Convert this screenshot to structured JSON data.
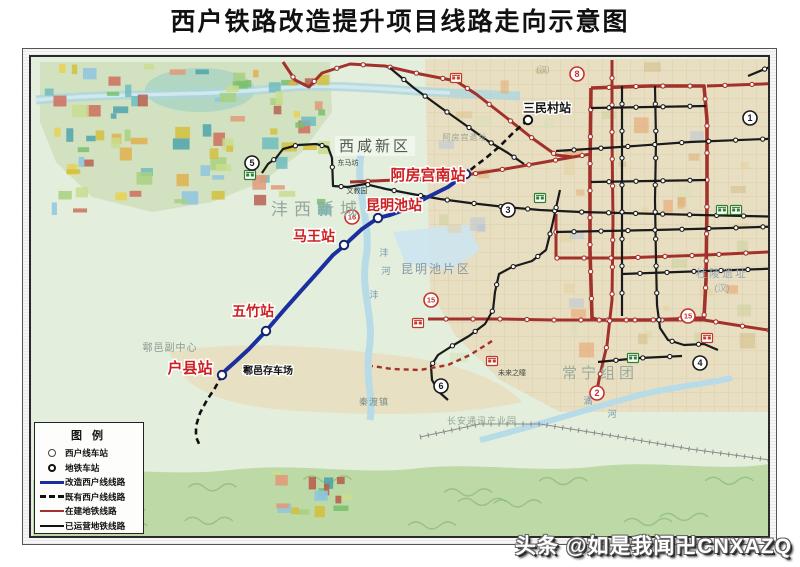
{
  "title": "西户铁路改造提升项目线路走向示意图",
  "watermark": "头条 @如是我闻卍CNXAZQ",
  "legend": {
    "title": "图例",
    "items": [
      {
        "symbol": "circle-thin",
        "label": "西户线车站"
      },
      {
        "symbol": "circle-bold",
        "label": "地铁车站"
      },
      {
        "symbol": "line-blue",
        "label": "改造西户线线路"
      },
      {
        "symbol": "line-dash",
        "label": "既有西户线线路"
      },
      {
        "symbol": "line-red",
        "label": "在建地铁线路"
      },
      {
        "symbol": "line-black",
        "label": "已运营地铁线路"
      }
    ]
  },
  "colors": {
    "renovated_line": "#1b2f9e",
    "metro_under_construction": "#a3312b",
    "metro_operating": "#1a1a1a",
    "station_label_red": "#cc1f1f",
    "badge_red": "#c2342c",
    "badge_black": "#1a1a1a"
  },
  "map": {
    "blue_line": {
      "points": [
        [
          466,
          174
        ],
        [
          448,
          187
        ],
        [
          426,
          198
        ],
        [
          404,
          210
        ],
        [
          390,
          215
        ],
        [
          378,
          218
        ],
        [
          362,
          229
        ],
        [
          350,
          240
        ],
        [
          344,
          246
        ],
        [
          333,
          255
        ],
        [
          318,
          272
        ],
        [
          300,
          292
        ],
        [
          284,
          310
        ],
        [
          266,
          331
        ],
        [
          249,
          349
        ],
        [
          235,
          362
        ],
        [
          226,
          370
        ],
        [
          222,
          375
        ]
      ]
    },
    "xihu_stations": [
      {
        "name": "阿房宫南站",
        "x": 466,
        "y": 174,
        "line": "blue"
      },
      {
        "name": "昆明池站",
        "x": 378,
        "y": 218,
        "line": "blue"
      },
      {
        "name": "马王站",
        "x": 344,
        "y": 245,
        "line": "blue"
      },
      {
        "name": "五竹站",
        "x": 266,
        "y": 331,
        "line": "blue"
      },
      {
        "name": "户县站",
        "x": 222,
        "y": 375,
        "line": "blue"
      },
      {
        "name": "三民村站",
        "x": 528,
        "y": 120,
        "line": "dash"
      }
    ],
    "dashed_lines": [
      [
        [
          528,
          120
        ],
        [
          514,
          132
        ],
        [
          500,
          146
        ],
        [
          486,
          158
        ],
        [
          474,
          167
        ],
        [
          466,
          174
        ]
      ],
      [
        [
          222,
          375
        ],
        [
          215,
          388
        ],
        [
          207,
          400
        ],
        [
          200,
          413
        ],
        [
          196,
          426
        ],
        [
          196,
          437
        ],
        [
          200,
          446
        ]
      ]
    ],
    "red_lines": [
      {
        "w": 3,
        "points": [
          [
            350,
            182
          ],
          [
            420,
            179
          ],
          [
            466,
            175
          ],
          [
            505,
            169
          ],
          [
            545,
            162
          ],
          [
            573,
            157
          ],
          [
            591,
            154
          ]
        ]
      },
      {
        "w": 3,
        "points": [
          [
            283,
            62
          ],
          [
            295,
            80
          ],
          [
            309,
            87
          ],
          [
            322,
            73
          ],
          [
            350,
            64
          ],
          [
            385,
            66
          ],
          [
            420,
            74
          ],
          [
            456,
            81
          ],
          [
            476,
            94
          ],
          [
            503,
            115
          ],
          [
            532,
            138
          ],
          [
            556,
            155
          ],
          [
            573,
            157
          ]
        ]
      },
      {
        "w": 3.6,
        "points": [
          [
            591,
            88
          ],
          [
            650,
            86
          ],
          [
            704,
            86
          ],
          [
            707,
            120
          ],
          [
            707,
            200
          ],
          [
            706,
            280
          ],
          [
            704,
            318
          ],
          [
            650,
            320
          ],
          [
            598,
            320
          ],
          [
            592,
            318
          ],
          [
            590,
            250
          ],
          [
            590,
            170
          ],
          [
            591,
            88
          ]
        ]
      },
      {
        "w": 3,
        "points": [
          [
            428,
            319
          ],
          [
            500,
            319
          ],
          [
            553,
            320
          ],
          [
            592,
            320
          ],
          [
            704,
            320
          ],
          [
            748,
            327
          ],
          [
            788,
            333
          ]
        ]
      },
      {
        "w": 3,
        "points": [
          [
            612,
            60
          ],
          [
            612,
            140
          ],
          [
            613,
            220
          ],
          [
            612,
            300
          ],
          [
            607,
            345
          ],
          [
            600,
            375
          ],
          [
            597,
            390
          ]
        ]
      },
      {
        "w": 3,
        "points": [
          [
            556,
            214
          ],
          [
            556,
            258
          ],
          [
            620,
            258
          ],
          [
            706,
            255
          ],
          [
            788,
            251
          ]
        ]
      },
      {
        "w": 3,
        "points": [
          [
            707,
            86
          ],
          [
            790,
            83
          ]
        ]
      }
    ],
    "red_dashed": [
      [
        [
          492,
          341
        ],
        [
          470,
          355
        ],
        [
          448,
          365
        ],
        [
          420,
          370
        ],
        [
          392,
          369
        ],
        [
          372,
          366
        ]
      ]
    ],
    "black_lines": [
      [
        [
          556,
          151
        ],
        [
          620,
          147
        ],
        [
          690,
          142
        ],
        [
          790,
          138
        ]
      ],
      [
        [
          748,
          76
        ],
        [
          772,
          66
        ],
        [
          795,
          58
        ]
      ],
      [
        [
          262,
          173
        ],
        [
          268,
          164
        ],
        [
          276,
          158
        ],
        [
          283,
          149
        ],
        [
          298,
          145
        ],
        [
          316,
          144
        ],
        [
          328,
          147
        ],
        [
          332,
          158
        ],
        [
          333,
          186
        ],
        [
          348,
          187
        ],
        [
          365,
          184
        ],
        [
          386,
          189
        ],
        [
          412,
          194
        ],
        [
          440,
          199
        ],
        [
          470,
          203
        ],
        [
          505,
          207
        ],
        [
          540,
          210
        ],
        [
          580,
          212
        ],
        [
          620,
          213
        ],
        [
          660,
          214
        ],
        [
          700,
          215
        ],
        [
          745,
          216
        ],
        [
          790,
          217
        ]
      ],
      [
        [
          560,
          190
        ],
        [
          552,
          226
        ],
        [
          546,
          250
        ],
        [
          532,
          261
        ],
        [
          512,
          267
        ],
        [
          499,
          274
        ],
        [
          495,
          292
        ],
        [
          493,
          310
        ],
        [
          485,
          324
        ],
        [
          469,
          336
        ],
        [
          452,
          346
        ],
        [
          438,
          355
        ],
        [
          431,
          366
        ],
        [
          432,
          380
        ],
        [
          439,
          392
        ],
        [
          448,
          400
        ]
      ],
      [
        [
          655,
          86
        ],
        [
          656,
          140
        ],
        [
          655,
          200
        ],
        [
          656,
          260
        ],
        [
          657,
          305
        ],
        [
          660,
          328
        ],
        [
          668,
          340
        ],
        [
          684,
          345
        ],
        [
          704,
          344
        ],
        [
          718,
          350
        ]
      ],
      [
        [
          622,
          86
        ],
        [
          622,
          316
        ]
      ],
      [
        [
          591,
          108
        ],
        [
          706,
          106
        ]
      ],
      [
        [
          591,
          182
        ],
        [
          706,
          180
        ]
      ],
      [
        [
          556,
          232
        ],
        [
          655,
          230
        ],
        [
          730,
          228
        ],
        [
          790,
          226
        ]
      ],
      [
        [
          622,
          274
        ],
        [
          706,
          271
        ],
        [
          790,
          268
        ]
      ],
      [
        [
          390,
          68
        ],
        [
          414,
          88
        ],
        [
          440,
          107
        ],
        [
          464,
          124
        ],
        [
          488,
          141
        ],
        [
          508,
          153
        ],
        [
          524,
          164
        ]
      ],
      [
        [
          598,
          362
        ],
        [
          640,
          358
        ],
        [
          682,
          356
        ]
      ]
    ],
    "badges": [
      {
        "n": "5",
        "color": "black",
        "x": 252,
        "y": 163
      },
      {
        "n": "16",
        "color": "red",
        "x": 352,
        "y": 217
      },
      {
        "n": "3",
        "color": "black",
        "x": 508,
        "y": 210
      },
      {
        "n": "8",
        "color": "red",
        "x": 577,
        "y": 74
      },
      {
        "n": "1",
        "color": "black",
        "x": 750,
        "y": 118
      },
      {
        "n": "15",
        "color": "red",
        "x": 431,
        "y": 300
      },
      {
        "n": "15",
        "color": "red",
        "x": 688,
        "y": 316
      },
      {
        "n": "6",
        "color": "black",
        "x": 441,
        "y": 386
      },
      {
        "n": "4",
        "color": "black",
        "x": 700,
        "y": 363
      },
      {
        "n": "2",
        "color": "red",
        "x": 597,
        "y": 393
      }
    ],
    "red_station_labels": [
      {
        "text": "阿房宫南站",
        "x": 428,
        "y": 180,
        "size": 15
      },
      {
        "text": "昆明池站",
        "x": 394,
        "y": 210,
        "size": 14
      },
      {
        "text": "马王站",
        "x": 314,
        "y": 241,
        "size": 14
      },
      {
        "text": "五竹站",
        "x": 253,
        "y": 316,
        "size": 14
      },
      {
        "text": "户县站",
        "x": 190,
        "y": 373,
        "size": 15
      }
    ],
    "black_station_labels": [
      {
        "text": "三民村站",
        "x": 547,
        "y": 112,
        "size": 12
      },
      {
        "text": "鄠邑存车场",
        "x": 268,
        "y": 374,
        "size": 10
      }
    ],
    "area_labels": [
      {
        "text": "西咸新区",
        "x": 375,
        "y": 151,
        "size": 15,
        "color": "#4f5b52",
        "ls": 3,
        "box": true
      },
      {
        "text": "沣西新城",
        "x": 317,
        "y": 215,
        "size": 17,
        "color": "#93a89c",
        "ls": 6
      },
      {
        "text": "昆明池片区",
        "x": 436,
        "y": 273,
        "size": 12,
        "color": "#8796a4",
        "ls": 2
      },
      {
        "text": "常宁组团",
        "x": 600,
        "y": 378,
        "size": 15,
        "color": "#98ab9e",
        "ls": 4
      },
      {
        "text": "鄠邑副中心",
        "x": 170,
        "y": 351,
        "size": 10,
        "color": "#8b9a8f",
        "ls": 1
      },
      {
        "text": "秦渡镇",
        "x": 374,
        "y": 405,
        "size": 9,
        "color": "#7e8d83",
        "ls": 1
      },
      {
        "text": "长安通讯产业园",
        "x": 482,
        "y": 424,
        "size": 9,
        "color": "#94a496",
        "ls": 1
      },
      {
        "text": "杜陵遗址",
        "x": 722,
        "y": 277,
        "size": 11,
        "color": "#97a6b2",
        "ls": 2
      },
      {
        "text": "(汉)",
        "x": 722,
        "y": 291,
        "size": 9,
        "color": "#97a6b2",
        "ls": 0
      },
      {
        "text": "阿房宫遗址",
        "x": 465,
        "y": 140,
        "size": 8,
        "color": "#9aa497",
        "ls": 1
      },
      {
        "text": "(汉)",
        "x": 543,
        "y": 72,
        "size": 8,
        "color": "#a0aaa0",
        "ls": 0
      }
    ],
    "small_labels": [
      {
        "text": "东马坊",
        "x": 348,
        "y": 165
      },
      {
        "text": "文教园",
        "x": 357,
        "y": 193
      },
      {
        "text": "未来之瞳",
        "x": 512,
        "y": 375
      }
    ],
    "river_labels": [
      {
        "text": "沣",
        "x": 384,
        "y": 256
      },
      {
        "text": "河",
        "x": 386,
        "y": 274
      },
      {
        "text": "沣",
        "x": 374,
        "y": 298
      },
      {
        "text": "潏",
        "x": 588,
        "y": 404
      },
      {
        "text": "河",
        "x": 612,
        "y": 417
      }
    ],
    "depots_red": [
      [
        456,
        78
      ],
      [
        418,
        323
      ],
      [
        492,
        361
      ],
      [
        707,
        338
      ]
    ],
    "depots_green": [
      [
        250,
        175
      ],
      [
        540,
        198
      ],
      [
        633,
        358
      ],
      [
        722,
        210
      ],
      [
        736,
        210
      ]
    ]
  }
}
